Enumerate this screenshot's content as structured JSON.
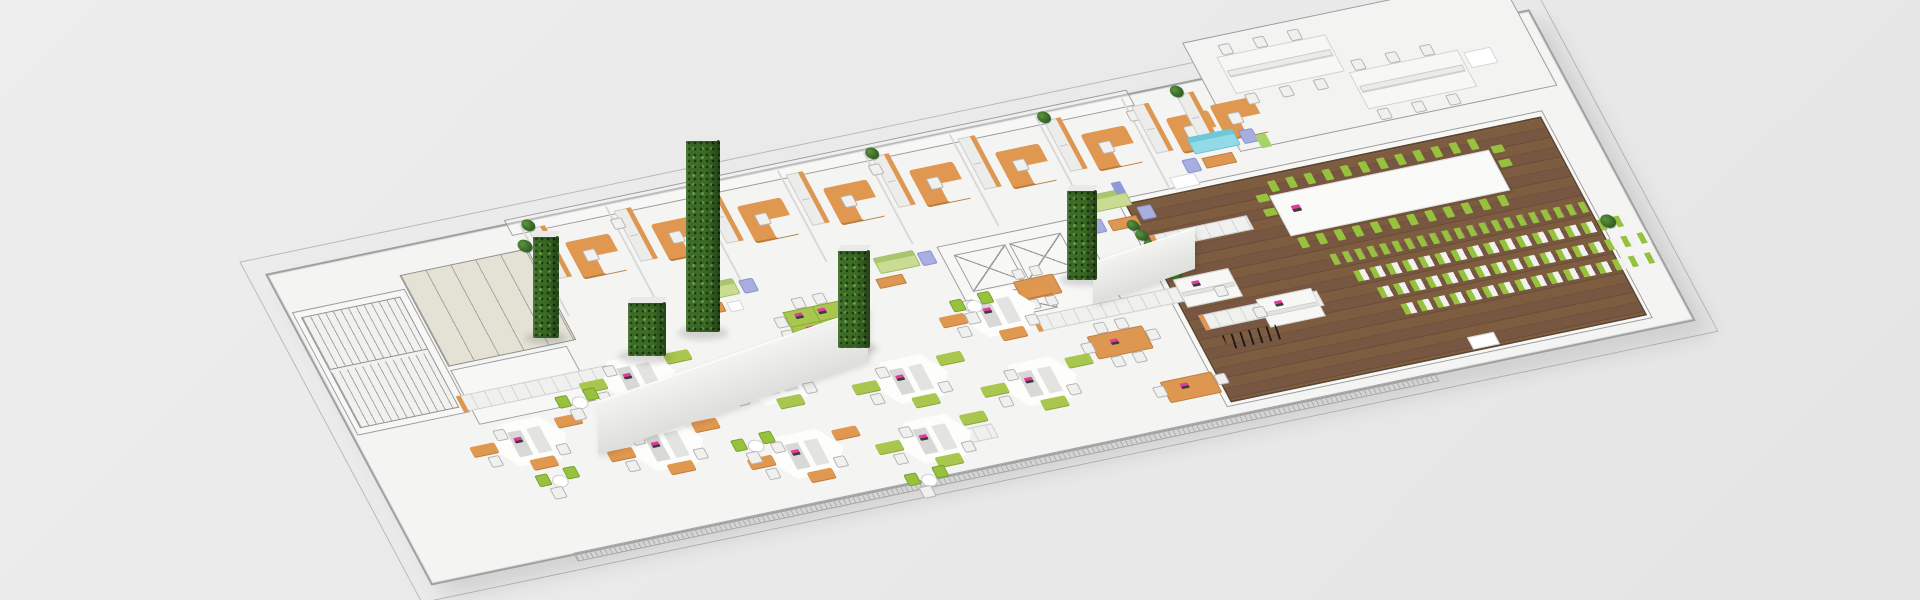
{
  "scene": {
    "label": "isometric-office-floorplan-render",
    "width": 1920,
    "height": 600,
    "background": "#e9e9e9"
  },
  "palette": {
    "background": "#e9e9e9",
    "floor": "#f4f4f2",
    "plan_line": "#9b9b9b",
    "wood_floor": "#74553c",
    "desk_orange": "#e09750",
    "desk_green": "#a9c64f",
    "chair_green": "#96c23e",
    "chair_white": "#f0f0ef",
    "sofa_green": "#c9dc92",
    "sofa_cyan": "#92dbe6",
    "chair_lavender": "#a8afe0",
    "plant_green": "#3c6c26",
    "laptop_screen": "#e23a9d",
    "wc_floor": "#e4e1d5"
  },
  "plane": {
    "matrix": [
      0.955,
      -0.2,
      0.47,
      0.88,
      265,
      274
    ],
    "width": 1320,
    "height": 350
  },
  "items": [
    {
      "type": "outline",
      "name": "building-outer-wall-line",
      "x": -18,
      "y": -18,
      "w": 1356,
      "h": 386
    },
    {
      "type": "slab",
      "name": "floor-slab",
      "x": 0,
      "y": 0,
      "w": 1320,
      "h": 350
    },
    {
      "type": "hatch",
      "name": "bottom-wall-hatch",
      "x": 150,
      "y": 351,
      "w": 900,
      "h": 8
    },
    {
      "type": "room",
      "name": "benching-room-floor",
      "x": 980,
      "y": -40,
      "w": 330,
      "h": 122
    },
    {
      "type": "lines",
      "name": "top-corridor-line",
      "x": 252,
      "y": -4,
      "w": 650,
      "h": 16
    },
    {
      "type": "lines",
      "name": "stair-room-outline",
      "x": 6,
      "y": 45,
      "w": 116,
      "h": 138
    },
    {
      "type": "stairs",
      "name": "stairwell-plan",
      "x": 12,
      "y": 52,
      "w": 102,
      "h": 124
    },
    {
      "type": "wc",
      "name": "wc-room-plan",
      "x": 126,
      "y": 30,
      "w": 132,
      "h": 102
    },
    {
      "type": "lines",
      "name": "storage-room-plan",
      "x": 126,
      "y": 138,
      "w": 120,
      "h": 60
    },
    {
      "type": "lines",
      "name": "elevator-core-outline",
      "x": 646,
      "y": 116,
      "w": 146,
      "h": 92
    },
    {
      "type": "xbox",
      "name": "elevator-shaft",
      "x": 658,
      "y": 128,
      "w": 52,
      "h": 40
    },
    {
      "type": "xbox",
      "name": "elevator-shaft",
      "x": 716,
      "y": 128,
      "w": 52,
      "h": 40
    },
    {
      "type": "xbox",
      "name": "service-shaft",
      "x": 676,
      "y": 176,
      "w": 52,
      "h": 26
    },
    {
      "type": "lines",
      "name": "conference-room-outline",
      "x": 839,
      "y": 106,
      "w": 444,
      "h": 234
    },
    {
      "type": "wood",
      "name": "conference-room-wood-floor",
      "x": 845,
      "y": 112,
      "w": 432,
      "h": 222
    },
    {
      "type": "vline",
      "name": "office-divider-wall",
      "x": 264,
      "y": 4,
      "w": 2,
      "h": 104,
      "n": 8,
      "dx": 90
    },
    {
      "type": "shelf",
      "name": "office-bookshelf",
      "x": 270,
      "y": 10,
      "w": 16,
      "h": 56,
      "n": 7,
      "dx": 90
    },
    {
      "type": "udesk",
      "name": "office-desk-orange",
      "x": 298,
      "y": 32,
      "w": 46,
      "h": 40,
      "n": 7,
      "dx": 90
    },
    {
      "type": "chairW",
      "name": "office-chair",
      "x": 310,
      "y": 44,
      "w": 11,
      "h": 11,
      "n": 7,
      "dx": 90
    },
    {
      "type": "plant",
      "name": "potted-plant",
      "x": 266,
      "y": 0,
      "w": 13,
      "h": 13,
      "n": 4,
      "dx": 180
    },
    {
      "type": "chairW",
      "name": "guest-chair",
      "x": 352,
      "y": 18,
      "w": 10,
      "h": 10,
      "n": 3,
      "dx": 270
    },
    {
      "type": "shelf",
      "name": "office-bookshelf",
      "x": 900,
      "y": 14,
      "w": 16,
      "h": 52
    },
    {
      "type": "udesk",
      "name": "office-desk-orange",
      "x": 926,
      "y": 34,
      "w": 44,
      "h": 38
    },
    {
      "type": "chairW",
      "name": "office-chair",
      "x": 938,
      "y": 46,
      "w": 11,
      "h": 11
    },
    {
      "type": "shelf",
      "name": "office-bookshelf",
      "x": 948,
      "y": 12,
      "w": 16,
      "h": 52
    },
    {
      "type": "udesk",
      "name": "office-desk-orange",
      "x": 974,
      "y": 30,
      "w": 44,
      "h": 38
    },
    {
      "type": "chairW",
      "name": "office-chair",
      "x": 986,
      "y": 42,
      "w": 11,
      "h": 11
    },
    {
      "type": "plant",
      "name": "potted-plant",
      "x": 944,
      "y": 2,
      "w": 13,
      "h": 13
    },
    {
      "type": "bdesk",
      "name": "bench-desk",
      "x": 1005,
      "y": -18,
      "w": 112,
      "h": 40
    },
    {
      "type": "bdesk",
      "name": "bench-desk",
      "x": 1122,
      "y": 26,
      "w": 112,
      "h": 40
    },
    {
      "type": "screen",
      "name": "desk-divider-screen",
      "x": 1008,
      "y": -2,
      "w": 106,
      "h": 5
    },
    {
      "type": "screen",
      "name": "desk-divider-screen",
      "x": 1125,
      "y": 42,
      "w": 106,
      "h": 5
    },
    {
      "type": "chairW",
      "name": "task-chair",
      "x": 1012,
      "y": -30,
      "w": 10,
      "h": 10,
      "n": 3,
      "dx": 36
    },
    {
      "type": "chairW",
      "name": "task-chair",
      "x": 1012,
      "y": 26,
      "w": 10,
      "h": 10,
      "n": 3,
      "dx": 36
    },
    {
      "type": "chairW",
      "name": "task-chair",
      "x": 1129,
      "y": 14,
      "w": 10,
      "h": 10,
      "n": 3,
      "dx": 36
    },
    {
      "type": "chairW",
      "name": "task-chair",
      "x": 1129,
      "y": 70,
      "w": 10,
      "h": 10,
      "n": 3,
      "dx": 36
    },
    {
      "type": "whitepad",
      "name": "pedestal-cabinet",
      "x": 1240,
      "y": 30,
      "w": 26,
      "h": 16
    },
    {
      "type": "sofaG",
      "name": "lounge-sofa-green",
      "x": 396,
      "y": 104,
      "w": 40,
      "h": 16
    },
    {
      "type": "chairL",
      "name": "lounge-chair-lavender",
      "x": 442,
      "y": 108,
      "w": 13,
      "h": 13
    },
    {
      "type": "bench",
      "name": "coffee-bench-wood",
      "x": 388,
      "y": 126,
      "w": 26,
      "h": 9
    },
    {
      "type": "whitepad",
      "name": "side-table",
      "x": 420,
      "y": 128,
      "w": 12,
      "h": 9
    },
    {
      "type": "sofaG",
      "name": "lounge-sofa-green",
      "x": 580,
      "y": 114,
      "w": 40,
      "h": 16
    },
    {
      "type": "chairL",
      "name": "lounge-chair-lavender",
      "x": 624,
      "y": 118,
      "w": 13,
      "h": 13
    },
    {
      "type": "bench",
      "name": "coffee-bench-wood",
      "x": 572,
      "y": 136,
      "w": 26,
      "h": 9
    },
    {
      "type": "sofaG",
      "name": "lounge-sofa-green",
      "x": 806,
      "y": 96,
      "w": 44,
      "h": 17
    },
    {
      "type": "chairL",
      "name": "lounge-chair-lavender",
      "x": 800,
      "y": 122,
      "w": 13,
      "h": 13
    },
    {
      "type": "chairL",
      "name": "lounge-chair-lavender",
      "x": 854,
      "y": 118,
      "w": 13,
      "h": 13
    },
    {
      "type": "bench",
      "name": "coffee-bench-wood",
      "x": 820,
      "y": 126,
      "w": 28,
      "h": 10
    },
    {
      "type": "board",
      "name": "pin-board",
      "x": 842,
      "y": 88,
      "w": 10,
      "h": 13,
      "color": "#8f98d8"
    },
    {
      "type": "board",
      "name": "pin-board",
      "x": 806,
      "y": 88,
      "w": 10,
      "h": 13,
      "color": "#7b8450"
    },
    {
      "type": "sofaC",
      "name": "lounge-sofa-cyan",
      "x": 936,
      "y": 58,
      "w": 46,
      "h": 17
    },
    {
      "type": "chairL",
      "name": "lounge-chair-lavender",
      "x": 988,
      "y": 62,
      "w": 13,
      "h": 13
    },
    {
      "type": "bench",
      "name": "coffee-bench-wood",
      "x": 940,
      "y": 82,
      "w": 30,
      "h": 10
    },
    {
      "type": "board",
      "name": "pin-board",
      "x": 1002,
      "y": 70,
      "w": 11,
      "h": 15,
      "color": "#a8d36a"
    },
    {
      "type": "chairL",
      "name": "lounge-chair-lavender",
      "x": 920,
      "y": 80,
      "w": 13,
      "h": 13
    },
    {
      "type": "plant",
      "name": "potted-plant-row",
      "x": 836,
      "y": 130,
      "w": 12,
      "h": 12,
      "n": 6,
      "dx": 3,
      "dy": 12
    },
    {
      "type": "plant",
      "name": "potted-plant",
      "x": 252,
      "y": 20,
      "w": 14,
      "h": 14
    },
    {
      "type": "cab",
      "name": "locker-row",
      "x": 118,
      "y": 166,
      "w": 192,
      "h": 16
    },
    {
      "type": "cab",
      "name": "storage-cabinet-row",
      "x": 700,
      "y": 208,
      "w": 150,
      "h": 15
    },
    {
      "type": "cab",
      "name": "storage-cabinet-row",
      "x": 858,
      "y": 242,
      "w": 122,
      "h": 15
    },
    {
      "type": "cab",
      "name": "storage-cabinet",
      "x": 545,
      "y": 308,
      "w": 62,
      "h": 14
    },
    {
      "type": "cab",
      "name": "storage-cabinet-row",
      "x": 852,
      "y": 150,
      "w": 100,
      "h": 14
    },
    {
      "type": "bdesk",
      "name": "white-desk",
      "x": 852,
      "y": 200,
      "w": 56,
      "h": 30
    },
    {
      "type": "laptop",
      "name": "laptop",
      "x": 868,
      "y": 206,
      "w": 8,
      "h": 6
    },
    {
      "type": "chairW",
      "name": "task-chair",
      "x": 886,
      "y": 216,
      "w": 10,
      "h": 10
    },
    {
      "type": "bdesk",
      "name": "white-desk",
      "x": 920,
      "y": 238,
      "w": 56,
      "h": 30
    },
    {
      "type": "chairW",
      "name": "task-chair",
      "x": 912,
      "y": 246,
      "w": 10,
      "h": 10
    },
    {
      "type": "laptop",
      "name": "laptop",
      "x": 936,
      "y": 244,
      "w": 8,
      "h": 6
    },
    {
      "type": "otable",
      "name": "meeting-table-orange",
      "x": 742,
      "y": 240,
      "w": 56,
      "h": 24
    },
    {
      "type": "chairW",
      "name": "task-chair",
      "x": 732,
      "y": 246,
      "w": 10,
      "h": 10
    },
    {
      "type": "chairW",
      "name": "task-chair",
      "x": 800,
      "y": 246,
      "w": 10,
      "h": 10
    },
    {
      "type": "chairW",
      "name": "task-chair",
      "x": 754,
      "y": 228,
      "w": 10,
      "h": 10,
      "n": 2,
      "dx": 22
    },
    {
      "type": "chairW",
      "name": "task-chair",
      "x": 754,
      "y": 266,
      "w": 10,
      "h": 10,
      "n": 2,
      "dx": 22
    },
    {
      "type": "laptop",
      "name": "laptop",
      "x": 762,
      "y": 248,
      "w": 8,
      "h": 6
    },
    {
      "type": "otable",
      "name": "desk-orange",
      "x": 788,
      "y": 302,
      "w": 52,
      "h": 22
    },
    {
      "type": "chairW",
      "name": "task-chair",
      "x": 778,
      "y": 306,
      "w": 10,
      "h": 10
    },
    {
      "type": "chairW",
      "name": "task-chair",
      "x": 842,
      "y": 306,
      "w": 10,
      "h": 10
    },
    {
      "type": "laptop",
      "name": "laptop",
      "x": 806,
      "y": 308,
      "w": 8,
      "h": 6
    },
    {
      "type": "otable",
      "name": "meeting-table-orange",
      "x": 700,
      "y": 168,
      "w": 40,
      "h": 20
    },
    {
      "type": "chairW",
      "name": "task-chair",
      "x": 704,
      "y": 156,
      "w": 9,
      "h": 9,
      "n": 2,
      "dx": 18
    },
    {
      "type": "chairW",
      "name": "task-chair",
      "x": 704,
      "y": 190,
      "w": 9,
      "h": 9,
      "n": 2,
      "dx": 18
    },
    {
      "type": "gtable",
      "name": "team-table-green",
      "x": 468,
      "y": 150,
      "w": 60,
      "h": 32
    },
    {
      "type": "laptop",
      "name": "laptop",
      "x": 478,
      "y": 154,
      "w": 8,
      "h": 6,
      "n": 2,
      "dx": 24
    },
    {
      "type": "laptop",
      "name": "laptop",
      "x": 482,
      "y": 170,
      "w": 8,
      "h": 6,
      "n": 2,
      "dx": 24
    },
    {
      "type": "chairW",
      "name": "task-chair",
      "x": 456,
      "y": 154,
      "w": 10,
      "h": 10,
      "n": 2,
      "dy": 15
    },
    {
      "type": "chairW",
      "name": "task-chair",
      "x": 532,
      "y": 154,
      "w": 10,
      "h": 10,
      "n": 2,
      "dy": 15
    },
    {
      "type": "chairW",
      "name": "task-chair",
      "x": 482,
      "y": 138,
      "w": 10,
      "h": 10,
      "n": 2,
      "dx": 22
    },
    {
      "type": "chairW",
      "name": "task-chair",
      "x": 482,
      "y": 186,
      "w": 10,
      "h": 10,
      "n": 2,
      "dx": 22
    },
    {
      "type": "pod",
      "name": "hex-workstation-pod",
      "x": 105,
      "y": 195,
      "variant": "O"
    },
    {
      "type": "pod",
      "name": "hex-workstation-pod",
      "x": 232,
      "y": 229,
      "variant": "O"
    },
    {
      "type": "pod",
      "name": "hex-workstation-pod",
      "x": 360,
      "y": 267,
      "variant": "O"
    },
    {
      "type": "pod",
      "name": "hex-workstation-pod",
      "x": 488,
      "y": 279,
      "variant": "G"
    },
    {
      "type": "pod",
      "name": "hex-workstation-pod",
      "x": 240,
      "y": 153,
      "variant": "G"
    },
    {
      "type": "pod",
      "name": "hex-workstation-pod",
      "x": 368,
      "y": 185,
      "variant": "G"
    },
    {
      "type": "pod",
      "name": "hex-workstation-pod",
      "x": 496,
      "y": 213,
      "variant": "G"
    },
    {
      "type": "pod",
      "name": "hex-workstation-pod",
      "x": 616,
      "y": 243,
      "variant": "G"
    },
    {
      "type": "pod",
      "name": "hex-workstation-pod",
      "x": 612,
      "y": 163,
      "variant": "O"
    },
    {
      "type": "coffee",
      "name": "coffee-table-set",
      "x": 208,
      "y": 182
    },
    {
      "type": "coffee",
      "name": "coffee-table-set",
      "x": 352,
      "y": 264
    },
    {
      "type": "coffee",
      "name": "coffee-table-set",
      "x": 498,
      "y": 336
    },
    {
      "type": "coffee",
      "name": "coffee-table-set",
      "x": 628,
      "y": 168
    },
    {
      "type": "coffee",
      "name": "coffee-table-set",
      "x": 150,
      "y": 258
    },
    {
      "type": "conftable",
      "name": "conference-table",
      "x": 985,
      "y": 135,
      "w": 228,
      "h": 44
    },
    {
      "type": "laptop",
      "name": "laptop",
      "x": 1000,
      "y": 150,
      "w": 9,
      "h": 7
    },
    {
      "type": "gtick",
      "name": "conference-chair-green",
      "x": 990,
      "y": 120,
      "w": 8,
      "h": 12,
      "n": 12,
      "dx": 19
    },
    {
      "type": "gtick",
      "name": "conference-chair-green",
      "x": 990,
      "y": 184,
      "w": 8,
      "h": 12,
      "n": 12,
      "dx": 19
    },
    {
      "type": "gtick",
      "name": "conference-chair-green",
      "x": 972,
      "y": 132,
      "w": 12,
      "h": 8,
      "n": 2,
      "dy": 16
    },
    {
      "type": "gtick",
      "name": "conference-chair-green",
      "x": 1218,
      "y": 132,
      "w": 12,
      "h": 8,
      "n": 2,
      "dy": 16
    },
    {
      "type": "crowG",
      "name": "audience-chair-row",
      "x": 1012,
      "y": 208,
      "w": 272,
      "h": 12
    },
    {
      "type": "crowM",
      "name": "audience-chair-row",
      "x": 1026,
      "y": 230,
      "w": 282,
      "h": 12
    },
    {
      "type": "crowM",
      "name": "audience-chair-row",
      "x": 1040,
      "y": 252,
      "w": 282,
      "h": 12
    },
    {
      "type": "crowM",
      "name": "audience-chair-row",
      "x": 1054,
      "y": 274,
      "w": 272,
      "h": 12
    },
    {
      "type": "zigzag",
      "name": "floor-cable-squiggle",
      "x": 870,
      "y": 268,
      "w": 56,
      "h": 16
    },
    {
      "type": "plant",
      "name": "potted-plant",
      "x": 1284,
      "y": 226,
      "w": 15,
      "h": 15
    },
    {
      "type": "whitepad",
      "name": "floor-pad",
      "x": 1100,
      "y": 322,
      "w": 26,
      "h": 12
    },
    {
      "type": "whitepad",
      "name": "floor-pad",
      "x": 900,
      "y": 95,
      "w": 24,
      "h": 12
    }
  ],
  "uprights": [
    {
      "type": "shadow",
      "name": "pillar-shadow",
      "x": 525,
      "y": 332,
      "w": 42,
      "h": 12
    },
    {
      "type": "shadow",
      "name": "pillar-shadow",
      "x": 678,
      "y": 326,
      "w": 50,
      "h": 14
    },
    {
      "type": "shadow",
      "name": "pillar-shadow",
      "x": 830,
      "y": 342,
      "w": 48,
      "h": 13
    },
    {
      "type": "shadow",
      "name": "pillar-shadow",
      "x": 1060,
      "y": 274,
      "w": 44,
      "h": 12
    },
    {
      "type": "shadow",
      "name": "pillar-shadow",
      "x": 618,
      "y": 350,
      "w": 54,
      "h": 14
    },
    {
      "type": "wall",
      "name": "partition-wall-white",
      "x": 598,
      "y": 401,
      "w": 270,
      "h": 52,
      "skew": -19.2
    },
    {
      "type": "wall",
      "name": "partition-wall-white",
      "x": 1093,
      "y": 262,
      "w": 102,
      "h": 40,
      "skew": -19
    },
    {
      "type": "pillar",
      "name": "plant-wall-pillar",
      "x": 533,
      "y": 236,
      "w": 26,
      "h": 102
    },
    {
      "type": "pillar",
      "name": "plant-wall-pillar",
      "x": 686,
      "y": 140,
      "w": 34,
      "h": 192
    },
    {
      "type": "pillar",
      "name": "plant-wall-pillar",
      "x": 838,
      "y": 250,
      "w": 32,
      "h": 98
    },
    {
      "type": "pillar",
      "name": "plant-wall-pillar",
      "x": 1067,
      "y": 190,
      "w": 30,
      "h": 90
    },
    {
      "type": "pillar",
      "name": "plant-wall-pillar",
      "x": 628,
      "y": 302,
      "w": 38,
      "h": 54
    }
  ]
}
